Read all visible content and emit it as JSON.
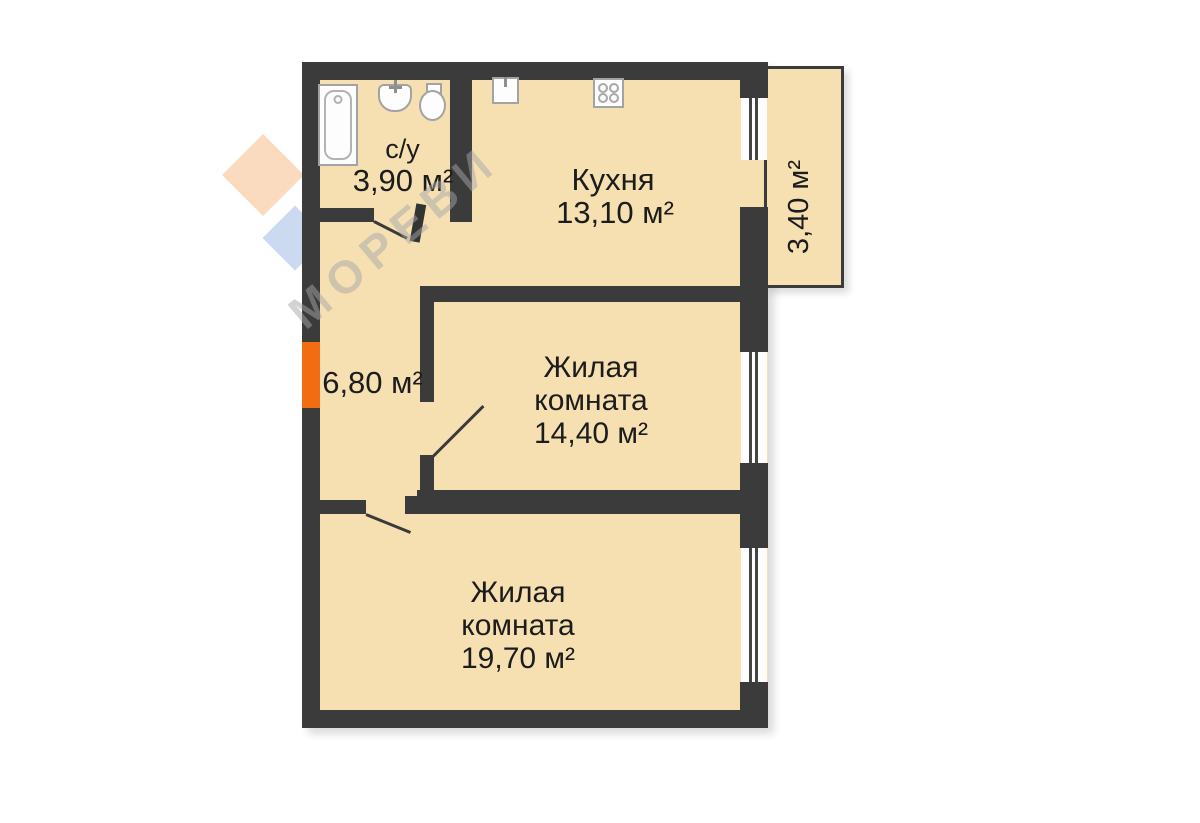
{
  "plan": {
    "rooms": {
      "bathroom": {
        "name": "с/у",
        "area": "3,90 м²"
      },
      "kitchen": {
        "name": "Кухня",
        "area": "13,10 м²"
      },
      "hallway": {
        "area": "6,80 м²"
      },
      "living_room_1": {
        "name_line_1": "Жилая",
        "name_line_2": "комната",
        "area": "14,40 м²"
      },
      "living_room_2": {
        "name_line_1": "Жилая",
        "name_line_2": "комната",
        "area": "19,70 м²"
      },
      "balcony": {
        "area": "3,40 м²"
      }
    },
    "icons": {
      "bathroom": [
        "bathtub-icon",
        "washbasin-icon",
        "toilet-icon"
      ],
      "kitchen": [
        "kitchen-sink-icon",
        "stove-icon"
      ],
      "openings": [
        "window-icon",
        "door-swing-icon",
        "door-leaf-icon",
        "entrance-marker"
      ]
    }
  },
  "watermark": {
    "text": "МОРЕВИ"
  },
  "colors": {
    "wall": "#3b3b3b",
    "floor": "#f6e0b2",
    "entrance_accent": "#f26d12",
    "label_text": "#1c1c1c",
    "fixture_outline": "#a3a3a3",
    "background": "#ffffff"
  }
}
